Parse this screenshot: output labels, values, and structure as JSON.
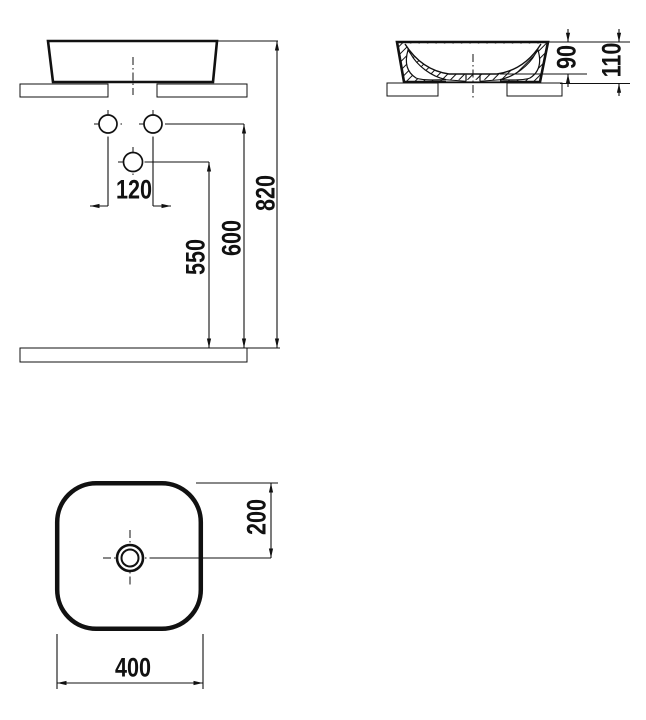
{
  "drawing": {
    "colors": {
      "line": "#111111",
      "background": "#ffffff"
    },
    "front_view": {
      "dimensions": {
        "hole_spacing": "120",
        "lower_hole_height": "550",
        "upper_hole_height": "600",
        "rim_height": "820"
      }
    },
    "side_view": {
      "dimensions": {
        "bowl_depth": "90",
        "overall_height": "110"
      }
    },
    "top_view": {
      "dimensions": {
        "drain_offset": "200",
        "basin_width": "400"
      }
    }
  }
}
